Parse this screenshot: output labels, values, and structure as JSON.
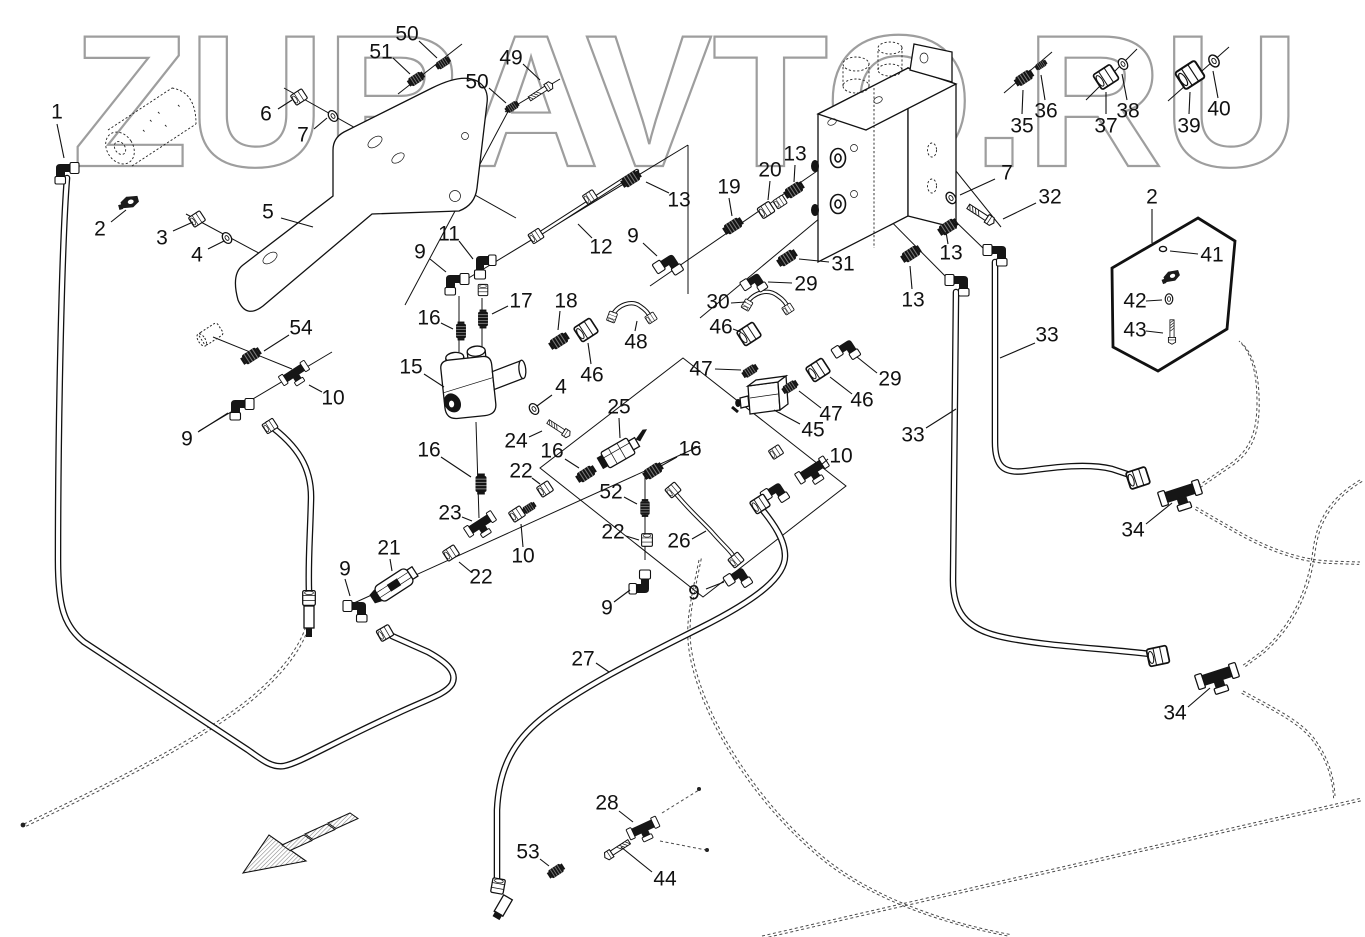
{
  "watermark": {
    "text": "ZURAVTO.RU",
    "color": "#9e9e9e"
  },
  "diagram": {
    "type": "exploded-parts-diagram",
    "arrow": {
      "direction": "lower-left",
      "style": "hatched"
    },
    "callouts": [
      {
        "label": "1",
        "x": 57,
        "y": 112,
        "leader": [
          57,
          124,
          64,
          158
        ]
      },
      {
        "label": "2",
        "x": 100,
        "y": 229,
        "leader": [
          111,
          222,
          126,
          210
        ]
      },
      {
        "label": "3",
        "x": 162,
        "y": 238,
        "leader": [
          173,
          231,
          193,
          222
        ]
      },
      {
        "label": "4",
        "x": 197,
        "y": 255,
        "leader": [
          208,
          249,
          224,
          241
        ]
      },
      {
        "label": "5",
        "x": 268,
        "y": 212,
        "leader": [
          281,
          218,
          313,
          227
        ]
      },
      {
        "label": "6",
        "x": 266,
        "y": 114,
        "leader": [
          278,
          109,
          292,
          100
        ]
      },
      {
        "label": "7",
        "x": 303,
        "y": 135,
        "leader": [
          314,
          129,
          327,
          118
        ]
      },
      {
        "label": "51",
        "x": 381,
        "y": 52,
        "leader": [
          393,
          58,
          410,
          74
        ]
      },
      {
        "label": "50",
        "x": 407,
        "y": 34,
        "leader": [
          419,
          41,
          437,
          58
        ]
      },
      {
        "label": "50",
        "x": 477,
        "y": 82,
        "leader": [
          489,
          88,
          506,
          103
        ]
      },
      {
        "label": "49",
        "x": 511,
        "y": 58,
        "leader": [
          523,
          64,
          540,
          80
        ]
      },
      {
        "label": "11",
        "x": 449,
        "y": 234,
        "leader": [
          459,
          241,
          473,
          259
        ]
      },
      {
        "label": "9",
        "x": 420,
        "y": 252,
        "leader": [
          430,
          259,
          446,
          272
        ]
      },
      {
        "label": "12",
        "x": 601,
        "y": 247,
        "leader": [
          592,
          238,
          578,
          224
        ]
      },
      {
        "label": "13",
        "x": 679,
        "y": 200,
        "leader": [
          669,
          193,
          646,
          182
        ]
      },
      {
        "label": "9",
        "x": 633,
        "y": 236,
        "leader": [
          643,
          243,
          657,
          256
        ]
      },
      {
        "label": "19",
        "x": 729,
        "y": 187,
        "leader": [
          729,
          198,
          732,
          216
        ]
      },
      {
        "label": "20",
        "x": 770,
        "y": 170,
        "leader": [
          770,
          181,
          768,
          200
        ]
      },
      {
        "label": "13",
        "x": 795,
        "y": 154,
        "leader": [
          795,
          165,
          794,
          182
        ]
      },
      {
        "label": "35",
        "x": 1022,
        "y": 126,
        "leader": [
          1022,
          114,
          1023,
          90
        ]
      },
      {
        "label": "36",
        "x": 1046,
        "y": 111,
        "leader": [
          1045,
          100,
          1041,
          75
        ]
      },
      {
        "label": "37",
        "x": 1106,
        "y": 126,
        "leader": [
          1106,
          114,
          1106,
          92
        ]
      },
      {
        "label": "38",
        "x": 1128,
        "y": 111,
        "leader": [
          1127,
          100,
          1122,
          74
        ]
      },
      {
        "label": "39",
        "x": 1189,
        "y": 126,
        "leader": [
          1189,
          114,
          1190,
          92
        ]
      },
      {
        "label": "40",
        "x": 1219,
        "y": 109,
        "leader": [
          1218,
          98,
          1213,
          71
        ]
      },
      {
        "label": "7",
        "x": 1007,
        "y": 173,
        "leader": [
          995,
          179,
          960,
          195
        ]
      },
      {
        "label": "32",
        "x": 1050,
        "y": 197,
        "leader": [
          1036,
          203,
          1003,
          219
        ]
      },
      {
        "label": "2",
        "x": 1152,
        "y": 197,
        "leader": [
          1152,
          209,
          1152,
          243
        ]
      },
      {
        "label": "41",
        "x": 1212,
        "y": 255,
        "leader": [
          1198,
          254,
          1170,
          251
        ]
      },
      {
        "label": "42",
        "x": 1135,
        "y": 301,
        "leader": [
          1146,
          301,
          1162,
          300
        ]
      },
      {
        "label": "43",
        "x": 1135,
        "y": 330,
        "leader": [
          1146,
          331,
          1163,
          333
        ]
      },
      {
        "label": "31",
        "x": 843,
        "y": 264,
        "leader": [
          829,
          262,
          799,
          259
        ]
      },
      {
        "label": "29",
        "x": 806,
        "y": 284,
        "leader": [
          792,
          283,
          768,
          282
        ]
      },
      {
        "label": "30",
        "x": 718,
        "y": 302,
        "leader": [
          731,
          303,
          746,
          302
        ]
      },
      {
        "label": "46",
        "x": 721,
        "y": 327,
        "leader": [
          733,
          329,
          741,
          332
        ]
      },
      {
        "label": "13",
        "x": 951,
        "y": 253,
        "leader": [
          948,
          244,
          946,
          232
        ]
      },
      {
        "label": "13",
        "x": 913,
        "y": 300,
        "leader": [
          912,
          289,
          910,
          266
        ]
      },
      {
        "label": "17",
        "x": 521,
        "y": 301,
        "leader": [
          508,
          306,
          492,
          314
        ]
      },
      {
        "label": "18",
        "x": 566,
        "y": 301,
        "leader": [
          560,
          311,
          558,
          330
        ]
      },
      {
        "label": "16",
        "x": 429,
        "y": 318,
        "leader": [
          441,
          323,
          453,
          329
        ]
      },
      {
        "label": "54",
        "x": 301,
        "y": 328,
        "leader": [
          289,
          335,
          264,
          351
        ]
      },
      {
        "label": "10",
        "x": 333,
        "y": 398,
        "leader": [
          322,
          392,
          309,
          385
        ]
      },
      {
        "label": "9",
        "x": 187,
        "y": 439,
        "leader": [
          198,
          432,
          228,
          413
        ]
      },
      {
        "label": "15",
        "x": 411,
        "y": 367,
        "leader": [
          424,
          374,
          444,
          387
        ]
      },
      {
        "label": "46",
        "x": 592,
        "y": 375,
        "leader": [
          591,
          364,
          588,
          343
        ]
      },
      {
        "label": "48",
        "x": 636,
        "y": 342,
        "leader": [
          635,
          331,
          637,
          321
        ]
      },
      {
        "label": "47",
        "x": 701,
        "y": 369,
        "leader": [
          715,
          369,
          741,
          370
        ]
      },
      {
        "label": "29",
        "x": 890,
        "y": 379,
        "leader": [
          877,
          373,
          857,
          357
        ]
      },
      {
        "label": "46",
        "x": 862,
        "y": 400,
        "leader": [
          852,
          394,
          830,
          377
        ]
      },
      {
        "label": "47",
        "x": 831,
        "y": 414,
        "leader": [
          821,
          408,
          799,
          391
        ]
      },
      {
        "label": "45",
        "x": 813,
        "y": 430,
        "leader": [
          800,
          424,
          774,
          410
        ]
      },
      {
        "label": "33",
        "x": 1047,
        "y": 335,
        "leader": [
          1035,
          343,
          1000,
          358
        ]
      },
      {
        "label": "33",
        "x": 913,
        "y": 435,
        "leader": [
          926,
          428,
          956,
          409
        ]
      },
      {
        "label": "25",
        "x": 619,
        "y": 407,
        "leader": [
          619,
          418,
          620,
          438
        ]
      },
      {
        "label": "4",
        "x": 561,
        "y": 387,
        "leader": [
          552,
          395,
          537,
          406
        ]
      },
      {
        "label": "24",
        "x": 516,
        "y": 441,
        "leader": [
          529,
          437,
          542,
          431
        ]
      },
      {
        "label": "16",
        "x": 552,
        "y": 451,
        "leader": [
          565,
          459,
          579,
          468
        ]
      },
      {
        "label": "16",
        "x": 690,
        "y": 449,
        "leader": [
          677,
          457,
          661,
          466
        ]
      },
      {
        "label": "16",
        "x": 429,
        "y": 450,
        "leader": [
          441,
          457,
          471,
          477
        ]
      },
      {
        "label": "22",
        "x": 521,
        "y": 471,
        "leader": [
          532,
          478,
          540,
          484
        ]
      },
      {
        "label": "52",
        "x": 611,
        "y": 492,
        "leader": [
          624,
          497,
          637,
          504
        ]
      },
      {
        "label": "22",
        "x": 613,
        "y": 532,
        "leader": [
          626,
          536,
          639,
          540
        ]
      },
      {
        "label": "26",
        "x": 679,
        "y": 541,
        "leader": [
          692,
          539,
          706,
          531
        ]
      },
      {
        "label": "23",
        "x": 450,
        "y": 513,
        "leader": [
          462,
          517,
          472,
          521
        ]
      },
      {
        "label": "10",
        "x": 523,
        "y": 556,
        "leader": [
          523,
          547,
          521,
          524
        ]
      },
      {
        "label": "21",
        "x": 389,
        "y": 548,
        "leader": [
          390,
          559,
          392,
          571
        ]
      },
      {
        "label": "22",
        "x": 481,
        "y": 577,
        "leader": [
          471,
          572,
          459,
          562
        ]
      },
      {
        "label": "9",
        "x": 345,
        "y": 569,
        "leader": [
          345,
          579,
          350,
          596
        ]
      },
      {
        "label": "9",
        "x": 607,
        "y": 608,
        "leader": [
          614,
          602,
          630,
          590
        ]
      },
      {
        "label": "9",
        "x": 694,
        "y": 593,
        "leader": [
          706,
          589,
          724,
          582
        ]
      },
      {
        "label": "10",
        "x": 841,
        "y": 456,
        "leader": [
          828,
          459,
          821,
          465
        ]
      },
      {
        "label": "27",
        "x": 583,
        "y": 659,
        "leader": [
          596,
          663,
          609,
          672
        ]
      },
      {
        "label": "34",
        "x": 1133,
        "y": 530,
        "leader": [
          1146,
          524,
          1172,
          503
        ]
      },
      {
        "label": "34",
        "x": 1175,
        "y": 713,
        "leader": [
          1188,
          707,
          1210,
          688
        ]
      },
      {
        "label": "28",
        "x": 607,
        "y": 803,
        "leader": [
          619,
          811,
          633,
          822
        ]
      },
      {
        "label": "53",
        "x": 528,
        "y": 852,
        "leader": [
          540,
          859,
          549,
          866
        ]
      },
      {
        "label": "44",
        "x": 665,
        "y": 879,
        "leader": [
          652,
          872,
          621,
          847
        ]
      }
    ]
  }
}
